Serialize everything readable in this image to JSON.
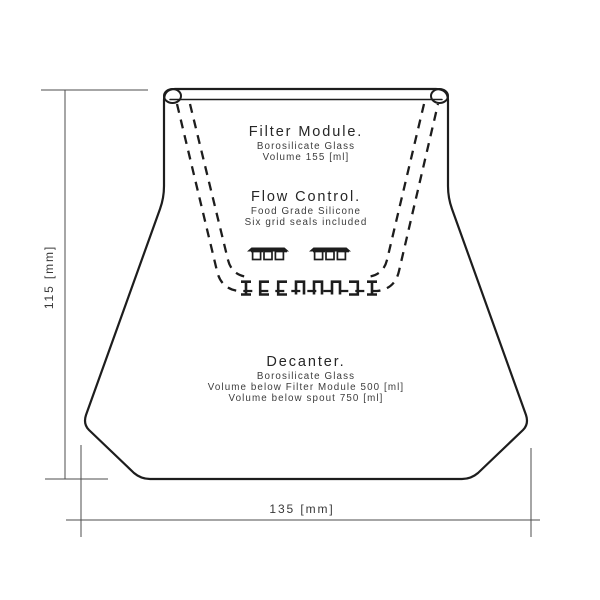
{
  "drawing": {
    "type": "technical-line-drawing",
    "subject": "coffee decanter with filter module, section view",
    "background": "#ffffff",
    "line_color": "#1d1d1d",
    "dimension_color": "#4d4d4d",
    "text_color": "#2e2e2e"
  },
  "annotations": {
    "filter_module": {
      "title": "Filter Module.",
      "line1": "Borosilicate Glass",
      "line2": "Volume 155 [ml]"
    },
    "flow_control": {
      "title": "Flow Control.",
      "line1": "Food Grade Silicone",
      "line2": "Six grid seals included"
    },
    "decanter": {
      "title": "Decanter.",
      "line1": "Borosilicate Glass",
      "line2": "Volume below Filter Module 500 [ml]",
      "line3": "Volume below spout 750 [ml]"
    }
  },
  "dimensions": {
    "height_label": "115 [mm]",
    "width_label": "135 [mm]"
  },
  "icons": {
    "tray": "grid-seal-tray-icon",
    "seal_row": "seal-cross-section-row-icon"
  }
}
